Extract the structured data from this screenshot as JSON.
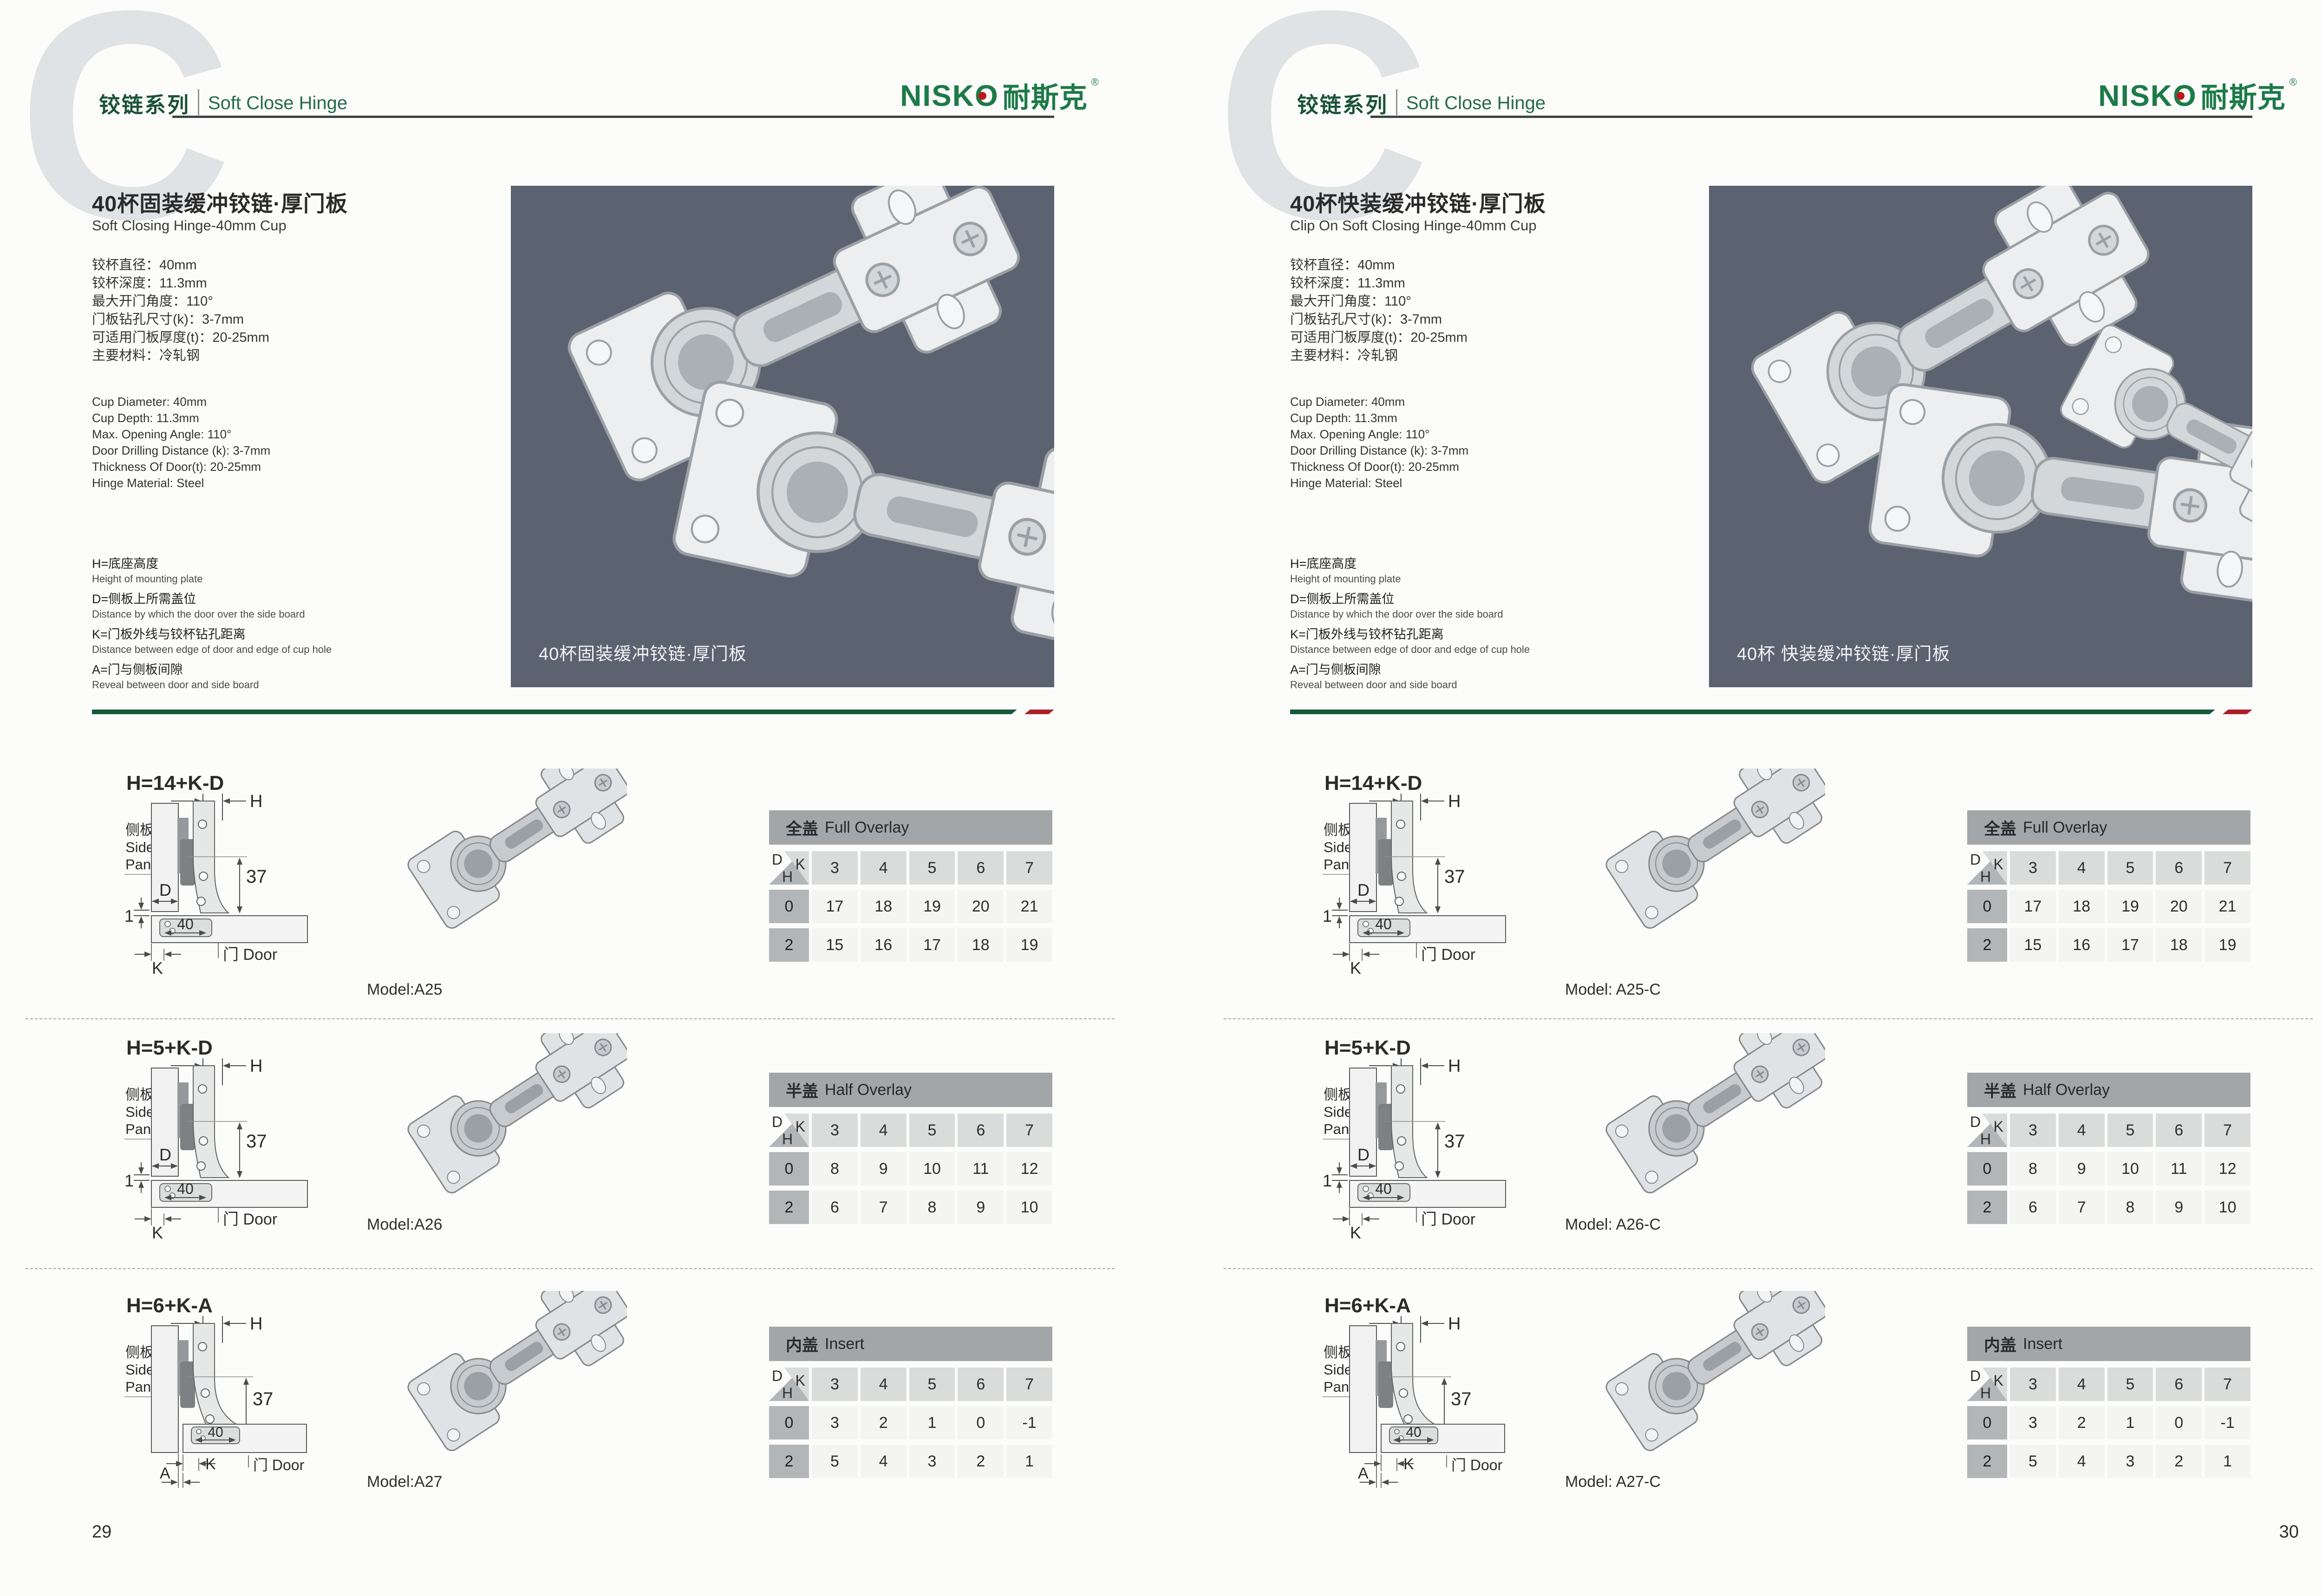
{
  "header": {
    "watermark": "C",
    "series_zh": "铰链系列",
    "series_en": "Soft Close Hinge",
    "logo_latin": "NISKO",
    "logo_zh": "耐斯克",
    "logo_reg": "®"
  },
  "colors": {
    "accent_green": "#1a5238",
    "logo_green": "#1d7a49",
    "divider_green": "#15593b",
    "divider_red": "#aa2026",
    "photo_bg": "#5b6270",
    "table_title_bg": "#a2a6a9",
    "header_cell_bg": "#dadcdb",
    "row_label_bg": "#b3b6b9",
    "data_cell_bg": "#f4f4f2"
  },
  "diagram_labels": {
    "side_panel_zh": "侧板",
    "side_panel_en1": "Side",
    "side_panel_en2": "Panel",
    "door_label": "门 Door",
    "dim_h": "H",
    "dim_d": "D",
    "dim_k": "K",
    "dim_a": "A",
    "dim_37": "37",
    "dim_40": "40",
    "dim_1": "1"
  },
  "pages": [
    {
      "page_number": "29",
      "title_zh": "40杯固装缓冲铰链·厚门板",
      "title_en": "Soft Closing Hinge-40mm Cup",
      "specs_zh": [
        "铰杯直径：40mm",
        "铰杯深度：11.3mm",
        "最大开门角度：110°",
        "门板钻孔尺寸(k)：3-7mm",
        "可适用门板厚度(t)：20-25mm",
        "主要材料：冷轧钢"
      ],
      "specs_en": [
        "Cup Diameter: 40mm",
        "Cup Depth: 11.3mm",
        "Max. Opening Angle: 110°",
        "Door Drilling Distance (k): 3-7mm",
        "Thickness Of Door(t): 20-25mm",
        "Hinge Material: Steel"
      ],
      "legend": [
        {
          "zh": "H=底座高度",
          "en": "Height of mounting plate"
        },
        {
          "zh": "D=侧板上所需盖位",
          "en": "Distance by which the door over the side board"
        },
        {
          "zh": "K=门板外线与铰杯钻孔距离",
          "en": "Distance between edge of door and edge of cup hole"
        },
        {
          "zh": "A=门与侧板间隙",
          "en": "Reveal between door and side board"
        }
      ],
      "photo_caption": "40杯固装缓冲铰链·厚门板",
      "sections": [
        {
          "formula": "H=14+K-D",
          "variant": "d",
          "model": "Model:A25",
          "table": {
            "title_zh": "全盖",
            "title_en": "Full Overlay",
            "k": [
              "3",
              "4",
              "5",
              "6",
              "7"
            ],
            "rows": [
              {
                "h": "0",
                "values": [
                  "17",
                  "18",
                  "19",
                  "20",
                  "21"
                ]
              },
              {
                "h": "2",
                "values": [
                  "15",
                  "16",
                  "17",
                  "18",
                  "19"
                ]
              }
            ]
          }
        },
        {
          "formula": "H=5+K-D",
          "variant": "d",
          "model": "Model:A26",
          "table": {
            "title_zh": "半盖",
            "title_en": "Half Overlay",
            "k": [
              "3",
              "4",
              "5",
              "6",
              "7"
            ],
            "rows": [
              {
                "h": "0",
                "values": [
                  "8",
                  "9",
                  "10",
                  "11",
                  "12"
                ]
              },
              {
                "h": "2",
                "values": [
                  "6",
                  "7",
                  "8",
                  "9",
                  "10"
                ]
              }
            ]
          }
        },
        {
          "formula": "H=6+K-A",
          "variant": "a",
          "model": "Model:A27",
          "table": {
            "title_zh": "内盖",
            "title_en": "Insert",
            "k": [
              "3",
              "4",
              "5",
              "6",
              "7"
            ],
            "rows": [
              {
                "h": "0",
                "values": [
                  "3",
                  "2",
                  "1",
                  "0",
                  "-1"
                ]
              },
              {
                "h": "2",
                "values": [
                  "5",
                  "4",
                  "3",
                  "2",
                  "1"
                ]
              }
            ]
          }
        }
      ]
    },
    {
      "page_number": "30",
      "title_zh": "40杯快装缓冲铰链·厚门板",
      "title_en": "Clip On Soft Closing Hinge-40mm Cup",
      "specs_zh": [
        "铰杯直径：40mm",
        "铰杯深度：11.3mm",
        "最大开门角度：110°",
        "门板钻孔尺寸(k)：3-7mm",
        "可适用门板厚度(t)：20-25mm",
        "主要材料：冷轧钢"
      ],
      "specs_en": [
        "Cup Diameter: 40mm",
        "Cup Depth: 11.3mm",
        "Max. Opening Angle: 110°",
        "Door Drilling Distance (k): 3-7mm",
        "Thickness Of Door(t): 20-25mm",
        "Hinge Material: Steel"
      ],
      "legend": [
        {
          "zh": "H=底座高度",
          "en": "Height of mounting plate"
        },
        {
          "zh": "D=侧板上所需盖位",
          "en": "Distance by which the door over the side board"
        },
        {
          "zh": "K=门板外线与铰杯钻孔距离",
          "en": "Distance between edge of door and edge of cup hole"
        },
        {
          "zh": "A=门与侧板间隙",
          "en": "Reveal between door and side board"
        }
      ],
      "photo_caption": "40杯 快装缓冲铰链·厚门板",
      "sections": [
        {
          "formula": "H=14+K-D",
          "variant": "d",
          "model": "Model: A25-C",
          "table": {
            "title_zh": "全盖",
            "title_en": "Full Overlay",
            "k": [
              "3",
              "4",
              "5",
              "6",
              "7"
            ],
            "rows": [
              {
                "h": "0",
                "values": [
                  "17",
                  "18",
                  "19",
                  "20",
                  "21"
                ]
              },
              {
                "h": "2",
                "values": [
                  "15",
                  "16",
                  "17",
                  "18",
                  "19"
                ]
              }
            ]
          }
        },
        {
          "formula": "H=5+K-D",
          "variant": "d",
          "model": "Model: A26-C",
          "table": {
            "title_zh": "半盖",
            "title_en": "Half Overlay",
            "k": [
              "3",
              "4",
              "5",
              "6",
              "7"
            ],
            "rows": [
              {
                "h": "0",
                "values": [
                  "8",
                  "9",
                  "10",
                  "11",
                  "12"
                ]
              },
              {
                "h": "2",
                "values": [
                  "6",
                  "7",
                  "8",
                  "9",
                  "10"
                ]
              }
            ]
          }
        },
        {
          "formula": "H=6+K-A",
          "variant": "a",
          "model": "Model: A27-C",
          "table": {
            "title_zh": "内盖",
            "title_en": "Insert",
            "k": [
              "3",
              "4",
              "5",
              "6",
              "7"
            ],
            "rows": [
              {
                "h": "0",
                "values": [
                  "3",
                  "2",
                  "1",
                  "0",
                  "-1"
                ]
              },
              {
                "h": "2",
                "values": [
                  "5",
                  "4",
                  "3",
                  "2",
                  "1"
                ]
              }
            ]
          }
        }
      ]
    }
  ]
}
